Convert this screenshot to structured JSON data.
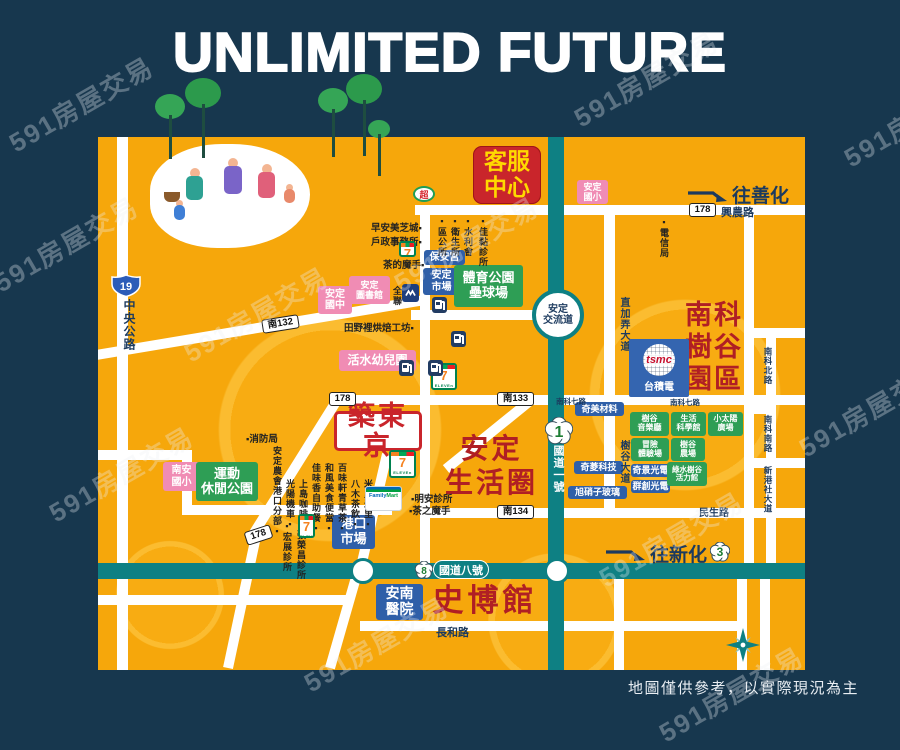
{
  "page": {
    "title": "UNLIMITED FUTURE",
    "disclaimer": "地圖僅供參考，以實際現況為主",
    "watermark_text": "591房屋交易"
  },
  "colors": {
    "background": "#17374E",
    "map": "#F6A70B",
    "highway_teal": "#0E8083",
    "red_badge": "#C9252B",
    "badge_yellow": "#FFD900",
    "pink_badge": "#F08CB4",
    "blue_badge": "#2F5FA8",
    "green_badge": "#2E9E55",
    "big_red_text": "#B01F24",
    "navy_text": "#1C3A5E"
  },
  "map": {
    "badges": [
      {
        "name": "service-center-badge",
        "type": "red",
        "x": 473,
        "y": 146,
        "w": 68,
        "h": 58,
        "fs": 23,
        "lines": [
          "客服",
          "中心"
        ]
      },
      {
        "name": "anding-elementary-badge",
        "type": "pink",
        "x": 577,
        "y": 180,
        "w": 31,
        "h": 24,
        "fs": 9,
        "lines": [
          "安定",
          "國小"
        ]
      },
      {
        "name": "anding-junior-high-badge",
        "type": "pink",
        "x": 318,
        "y": 286,
        "w": 34,
        "h": 28,
        "fs": 10,
        "lines": [
          "安定",
          "國中"
        ]
      },
      {
        "name": "anding-library-badge",
        "type": "pink",
        "x": 349,
        "y": 276,
        "w": 41,
        "h": 28,
        "fs": 9,
        "lines": [
          "安定",
          "圖書館"
        ]
      },
      {
        "name": "huoshui-kindergarten-badge",
        "type": "pink",
        "x": 339,
        "y": 350,
        "w": 77,
        "h": 21,
        "fs": 12,
        "lines": [
          "活水幼兒園"
        ]
      },
      {
        "name": "nanan-elementary-badge",
        "type": "pink",
        "x": 163,
        "y": 462,
        "w": 37,
        "h": 29,
        "fs": 10,
        "lines": [
          "南安",
          "國小"
        ]
      },
      {
        "name": "baoan-temple-badge",
        "type": "blue",
        "x": 424,
        "y": 250,
        "w": 41,
        "h": 15,
        "fs": 10,
        "lines": [
          "保安宮"
        ]
      },
      {
        "name": "anding-market-badge",
        "type": "blue",
        "x": 423,
        "y": 268,
        "w": 37,
        "h": 27,
        "fs": 10,
        "lines": [
          "安定",
          "市場"
        ]
      },
      {
        "name": "port-market-badge",
        "type": "blue",
        "x": 332,
        "y": 515,
        "w": 43,
        "h": 34,
        "fs": 13,
        "lines": [
          "港口",
          "市場"
        ]
      },
      {
        "name": "annan-hospital-badge",
        "type": "blue",
        "x": 376,
        "y": 584,
        "w": 47,
        "h": 36,
        "fs": 14,
        "lines": [
          "安南",
          "醫院"
        ]
      },
      {
        "name": "chimei-materials-badge",
        "type": "blue",
        "x": 575,
        "y": 402,
        "w": 49,
        "h": 14,
        "fs": 9,
        "lines": [
          "奇美材料"
        ]
      },
      {
        "name": "chilin-tech-badge",
        "type": "blue",
        "x": 574,
        "y": 461,
        "w": 49,
        "h": 13,
        "fs": 9,
        "lines": [
          "奇菱科技"
        ]
      },
      {
        "name": "asahi-glass-badge",
        "type": "blue",
        "x": 568,
        "y": 486,
        "w": 59,
        "h": 13,
        "fs": 9,
        "lines": [
          "旭硝子玻璃"
        ]
      },
      {
        "name": "himax-badge",
        "type": "blue",
        "x": 631,
        "y": 464,
        "w": 39,
        "h": 13,
        "fs": 9,
        "lines": [
          "奇景光電"
        ]
      },
      {
        "name": "innolux-badge",
        "type": "blue",
        "x": 631,
        "y": 480,
        "w": 39,
        "h": 13,
        "fs": 9,
        "lines": [
          "群創光電"
        ]
      },
      {
        "name": "sports-park-badge",
        "type": "green",
        "x": 454,
        "y": 265,
        "w": 69,
        "h": 42,
        "fs": 13,
        "lines": [
          "體育公園",
          "壘球場"
        ]
      },
      {
        "name": "leisure-park-badge",
        "type": "green",
        "x": 196,
        "y": 462,
        "w": 62,
        "h": 39,
        "fs": 13,
        "lines": [
          "運動",
          "休閒公園"
        ]
      },
      {
        "name": "shugu-concert-hall-badge",
        "type": "green",
        "x": 630,
        "y": 412,
        "w": 39,
        "h": 24,
        "fs": 8,
        "lines": [
          "樹谷",
          "音樂廳"
        ]
      },
      {
        "name": "life-science-museum-badge",
        "type": "green",
        "x": 671,
        "y": 412,
        "w": 35,
        "h": 24,
        "fs": 8,
        "lines": [
          "生活",
          "科學館"
        ]
      },
      {
        "name": "little-sun-plaza-badge",
        "type": "green",
        "x": 708,
        "y": 412,
        "w": 35,
        "h": 24,
        "fs": 8,
        "lines": [
          "小太陽",
          "廣場"
        ]
      },
      {
        "name": "adventure-field-badge",
        "type": "green",
        "x": 631,
        "y": 438,
        "w": 38,
        "h": 23,
        "fs": 8,
        "lines": [
          "冒險",
          "體驗場"
        ]
      },
      {
        "name": "shugu-farm-badge",
        "type": "green",
        "x": 671,
        "y": 438,
        "w": 34,
        "h": 23,
        "fs": 8,
        "lines": [
          "樹谷",
          "農場"
        ]
      },
      {
        "name": "vitality-hall-badge",
        "type": "green",
        "x": 667,
        "y": 462,
        "w": 40,
        "h": 24,
        "fs": 7.5,
        "lines": [
          "綠水樹谷",
          "活力館"
        ]
      },
      {
        "name": "project-badge",
        "type": "proj",
        "x": 334,
        "y": 411,
        "w": 88,
        "h": 40,
        "fs": 27,
        "lines": [
          "築東京"
        ]
      }
    ],
    "big_labels": [
      {
        "name": "anding-living-circle-label",
        "x": 434,
        "y": 432,
        "w": 115,
        "fs": 28,
        "lh": 34,
        "ls": 3,
        "lines": [
          "安定",
          "生活圈"
        ]
      },
      {
        "name": "nanke-shugu-park-label",
        "x": 684,
        "y": 299,
        "w": 60,
        "fs": 27,
        "lh": 32,
        "ls": 2,
        "lines": [
          "南科",
          "樹谷",
          "園區"
        ]
      },
      {
        "name": "history-museum-label",
        "x": 420,
        "y": 584,
        "w": 130,
        "fs": 31,
        "lh": 34,
        "ls": 4,
        "lines": [
          "史博館"
        ]
      }
    ],
    "road_badges": [
      {
        "kind": "rect",
        "text": "178",
        "x": 689,
        "y": 203
      },
      {
        "kind": "rect",
        "text": "178",
        "x": 329,
        "y": 392
      },
      {
        "kind": "rect",
        "text": "178",
        "x": 245,
        "y": 528,
        "rot": -18
      },
      {
        "kind": "rect",
        "text": "南132",
        "x": 262,
        "y": 317,
        "rot": -9,
        "w": 37
      },
      {
        "kind": "rect",
        "text": "南133",
        "x": 497,
        "y": 392,
        "w": 37
      },
      {
        "kind": "rect",
        "text": "南134",
        "x": 497,
        "y": 505,
        "w": 37
      },
      {
        "kind": "shield",
        "text": "19",
        "x": 111,
        "y": 274
      },
      {
        "kind": "plum",
        "text": "1",
        "x": 545,
        "y": 417,
        "r": 14
      },
      {
        "kind": "plum",
        "text": "8",
        "x": 415,
        "y": 561,
        "r": 9
      },
      {
        "kind": "plum",
        "text": "3",
        "x": 710,
        "y": 542,
        "r": 10
      }
    ],
    "road_names": [
      {
        "text": "興農路",
        "x": 721,
        "y": 204,
        "fs": 11
      },
      {
        "text": "中央公路",
        "x": 121,
        "y": 299,
        "fs": 12,
        "v": true
      },
      {
        "text": "直加弄大道",
        "x": 616,
        "y": 297,
        "fs": 10,
        "v": true
      },
      {
        "text": "樹谷大道",
        "x": 616,
        "y": 440,
        "fs": 10,
        "v": true
      },
      {
        "text": "國道一號",
        "x": 550,
        "y": 445,
        "fs": 11,
        "v": true,
        "color": "#FFFFFF"
      },
      {
        "text": "南科北路",
        "x": 762,
        "y": 347,
        "fs": 8.5,
        "v": true
      },
      {
        "text": "南科南路",
        "x": 762,
        "y": 415,
        "fs": 8.5,
        "v": true
      },
      {
        "text": "新港社大道",
        "x": 762,
        "y": 466,
        "fs": 8.5,
        "v": true
      },
      {
        "text": "民生路",
        "x": 699,
        "y": 504,
        "fs": 10
      },
      {
        "text": "長和路",
        "x": 436,
        "y": 624,
        "fs": 11
      },
      {
        "text": "南科七路",
        "x": 670,
        "y": 397,
        "fs": 7.5
      },
      {
        "text": "南科七路",
        "x": 556,
        "y": 396,
        "fs": 7.5
      }
    ],
    "pois": [
      {
        "text": "早安美芝城▪",
        "x": 371,
        "y": 220
      },
      {
        "text": "戶政事務所▪",
        "x": 371,
        "y": 234
      },
      {
        "text": "茶的魔手▪",
        "x": 383,
        "y": 257
      },
      {
        "text": "田野裡烘焙工坊▪",
        "x": 344,
        "y": 320
      },
      {
        "text": "▪消防局",
        "x": 246,
        "y": 431
      },
      {
        "text": "▪明安診所",
        "x": 411,
        "y": 491
      },
      {
        "text": "▪茶之魔手",
        "x": 409,
        "y": 503
      },
      {
        "text": "全聯",
        "x": 391,
        "y": 286,
        "v": true
      },
      {
        "text": "▪區公所",
        "x": 436,
        "y": 216,
        "v": true
      },
      {
        "text": "▪衛生所",
        "x": 449,
        "y": 216,
        "v": true
      },
      {
        "text": "▪水利會",
        "x": 462,
        "y": 216,
        "v": true
      },
      {
        "text": "▪佳黏診所",
        "x": 477,
        "y": 216,
        "v": true
      },
      {
        "text": "▪電信局",
        "x": 658,
        "y": 217,
        "v": true
      },
      {
        "text": "安定農會港口分部▪",
        "x": 271,
        "y": 446,
        "v": true
      },
      {
        "text": "光陽機車▪",
        "x": 284,
        "y": 479,
        "v": true
      },
      {
        "text": "上島咖啡▪",
        "x": 297,
        "y": 479,
        "v": true
      },
      {
        "text": "佳味香自助餐▪",
        "x": 310,
        "y": 463,
        "v": true
      },
      {
        "text": "和風美食便當▪",
        "x": 323,
        "y": 463,
        "v": true
      },
      {
        "text": "百味軒青草茶▪",
        "x": 336,
        "y": 463,
        "v": true
      },
      {
        "text": "八木茶飲▪",
        "x": 349,
        "y": 479,
        "v": true
      },
      {
        "text": "米里米里▪",
        "x": 362,
        "y": 479,
        "v": true
      },
      {
        "text": "▪宏展診所",
        "x": 281,
        "y": 521,
        "v": true
      },
      {
        "text": "▪張榮昌診所",
        "x": 295,
        "y": 519,
        "v": true
      }
    ],
    "arrows": [
      {
        "name": "to-shanhua-arrow",
        "text": "往善化",
        "x": 686,
        "y": 181
      },
      {
        "name": "to-xinhua-arrow",
        "text": "往新化",
        "x": 604,
        "y": 540
      }
    ],
    "interchange": {
      "lines": [
        "安定",
        "交流道"
      ],
      "x": 532,
      "y": 289,
      "d": 52
    },
    "highway_pill": {
      "text": "國道八號",
      "x": 433,
      "y": 560,
      "w": 56,
      "h": 19
    },
    "brands": [
      {
        "brand": "seven",
        "x": 399,
        "y": 241,
        "w": 17,
        "h": 16
      },
      {
        "brand": "seven",
        "x": 431,
        "y": 363,
        "w": 26,
        "h": 27
      },
      {
        "brand": "seven",
        "x": 389,
        "y": 450,
        "w": 27,
        "h": 28
      },
      {
        "brand": "seven",
        "x": 298,
        "y": 514,
        "w": 17,
        "h": 24
      },
      {
        "brand": "family",
        "x": 365,
        "y": 486,
        "w": 37,
        "h": 25
      },
      {
        "brand": "pxmart",
        "x": 402,
        "y": 284,
        "w": 17,
        "h": 18
      },
      {
        "brand": "super",
        "x": 413,
        "y": 186,
        "w": 22,
        "h": 16
      },
      {
        "brand": "gas",
        "x": 432,
        "y": 297,
        "w": 15,
        "h": 16
      },
      {
        "brand": "gas",
        "x": 451,
        "y": 315,
        "w": 15,
        "h": 16
      },
      {
        "brand": "gas",
        "x": 428,
        "y": 328,
        "w": 15,
        "h": 16
      },
      {
        "brand": "gas",
        "x": 399,
        "y": 312,
        "w": 15,
        "h": 16
      }
    ],
    "tsmc": {
      "x": 629,
      "y": 339,
      "w": 60,
      "h": 58,
      "logo_text": "tsmc",
      "label": "台積電"
    }
  },
  "watermarks": [
    [
      -15,
      225
    ],
    [
      0,
      85
    ],
    [
      175,
      295
    ],
    [
      385,
      225
    ],
    [
      565,
      60
    ],
    [
      790,
      390
    ],
    [
      590,
      520
    ],
    [
      295,
      625
    ],
    [
      650,
      675
    ],
    [
      835,
      100
    ],
    [
      40,
      455
    ]
  ]
}
